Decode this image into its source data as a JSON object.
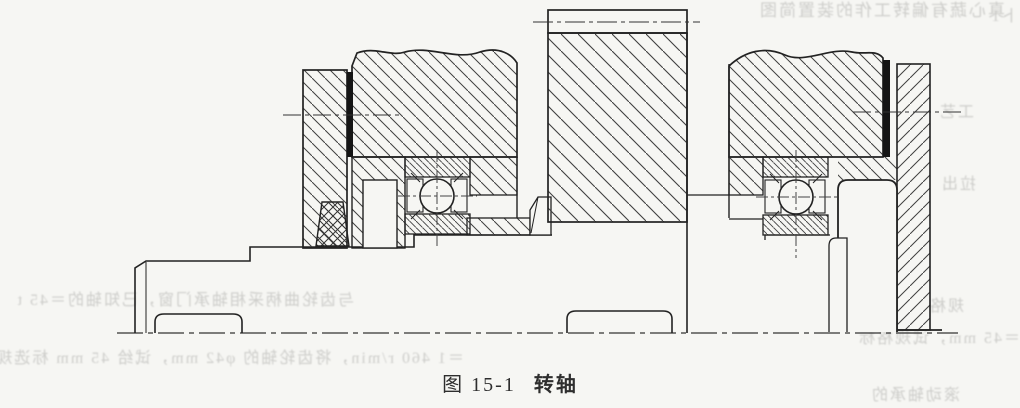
{
  "figure": {
    "caption_label": "图 15-1",
    "caption_title": "转轴"
  },
  "colors": {
    "paper": "#f6f6f3",
    "ink": "#2b2b2b",
    "hatch": "#3f3f3f",
    "ghost_text": "#c3c3c0"
  },
  "ghost_text": {
    "items": [
      {
        "text": "真心蔬有偏转工作的装置简图"
      },
      {
        "text": "卜1"
      },
      {
        "text": "与齿轮曲柄采相轴承门窗，已知轴的＝45 t"
      },
      {
        "text": "＝1 460 r/min，将齿轮轴的 φ42 mm，试给 45 mm 标选规"
      },
      {
        "text": "工艺"
      },
      {
        "text": "＝45 mm，试规格标"
      },
      {
        "text": "滚动轴承的"
      },
      {
        "text": "拉出"
      },
      {
        "text": "规格"
      }
    ]
  }
}
